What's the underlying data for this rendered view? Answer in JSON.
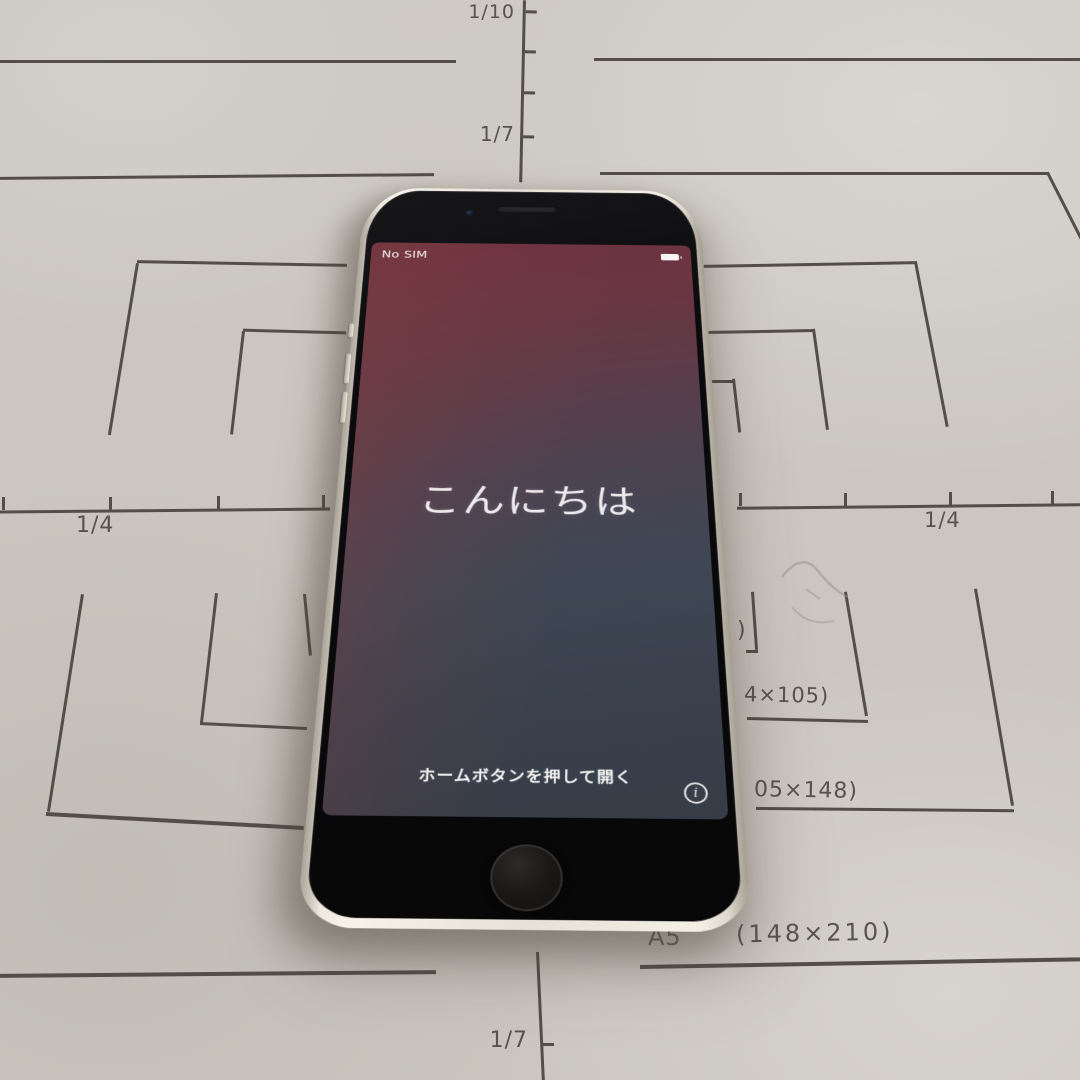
{
  "paper": {
    "background_color": "#cbc7c0",
    "ink_color": "#534e48",
    "top_ruler": {
      "label_1_10": "1/10",
      "label_1_7": "1/7"
    },
    "quarter_ruler": {
      "left_label": "1/4",
      "right_label": "1/4"
    },
    "bottom_ruler": {
      "label_1_7": "1/7"
    },
    "size_marks": {
      "b7_fragment": ")",
      "a7_fragment": "4×105)",
      "a6_fragment": "05×148)",
      "a5_name": "A5",
      "a5_dims": "(148×210)"
    }
  },
  "phone": {
    "status_bar": {
      "carrier": "No SIM",
      "battery_icon": "battery-full"
    },
    "screen": {
      "greeting": "こんにちは",
      "instruction": "ホームボタンを押して開く",
      "info_icon": "i"
    },
    "colors": {
      "wallpaper_top": "#6e3140",
      "wallpaper_mid": "#4a4352",
      "wallpaper_bottom": "#363d47",
      "frame": "#e7e2d8"
    }
  }
}
